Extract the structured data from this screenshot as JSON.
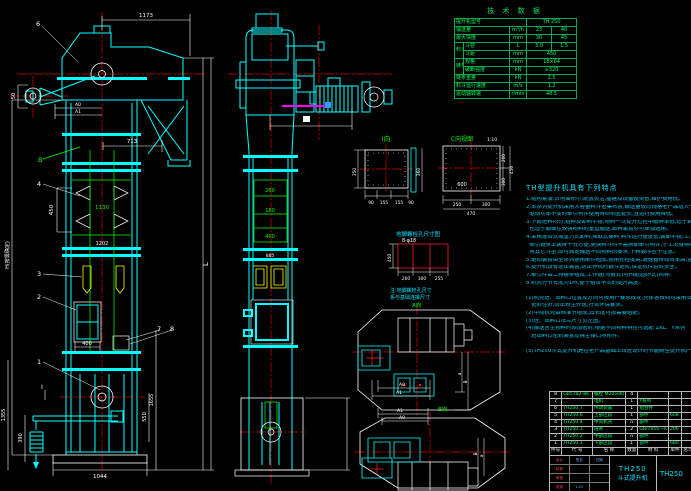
{
  "tech": {
    "title": "技 术 数 据",
    "rows": [
      {
        "label": "提升机型号",
        "v": "TH 250"
      },
      {
        "label": "输送量",
        "unit": "m³/h",
        "v1": "23",
        "v2": "40"
      },
      {
        "label": "最大块度",
        "unit": "mm",
        "v1": "30",
        "v2": "45"
      },
      {
        "group": "料斗",
        "label": "斗容",
        "unit": "L",
        "v1": "3.0",
        "v2": "1.5"
      },
      {
        "label": "斗距",
        "unit": "mm",
        "v": "450"
      },
      {
        "group": "链条",
        "label": "规格",
        "unit": "mm",
        "v": "18×64"
      },
      {
        "label": "破断强度",
        "unit": "kN",
        "v": "≥320"
      },
      {
        "label": "链条重量",
        "unit": "kN",
        "v": "2.5"
      },
      {
        "label": "料斗运行速度",
        "unit": "m/s",
        "v": "1.2"
      },
      {
        "label": "驱动轴转速",
        "unit": "r/min",
        "v": "48.5"
      }
    ]
  },
  "notes": {
    "title": "TH型提升机具有下列特点",
    "lines": [
      "1.结构紧凑,占地面积小,配置灵活,基建及设备投资省,维护费用低。",
      "2.本系列提升机采用大容量料斗密集布置,输送量较同规格老产品增大一倍,提升高度及",
      "  驱动功率不变时牵引构件使用寿命明显延长,且运行费用降低。",
      "3.下部进料均匀,给料及卸料平稳,物料一次提升过程中破碎率低,适于颗粒状及小块状,",
      "  也适于磨琢性较强物料的垂直输送,卸料装置亦可单独选用。",
      "4.采用混合式或重力式卸料,掏取式装料,料斗运行速度低,装卸平稳,工况适应性强,料斗在",
      "  牵引链条上装拆十分方便,更换料斗时不需拆卸牵引构件,于工况有特殊需要时可换",
      "  用其它斗型,即可满足输送不同物料的要求,下料顺序应予注意。",
      "5.驱动装置由全系列通用部件组成,通用化程度高,减速器传动效率高,运转可靠,噪声低。",
      "6.提升机设有逆止装置,防止停机时链斗逆转,保证机件运转安全。",
      "7.牵引件由二排链条组成,工作链(弯板式)与H链(圆环式)两种。",
      "8.机壳分节长度为1m,便于组合不同的提升高度。",
      "",
      "(1)机壳进、出料口位置及方向可按用户要求改变,壳体各段间均采用法兰密封连接,整机",
      "   密封性好,防止粉尘外逸,符合环保要求。",
      "(2)中间机壳由标准节组成,其长度可按需要组配。",
      "(3)进、出料口法兰尺寸见左图。",
      "(4)输送含尘物料时须加密封,根据不同物料特性可选配 ZKL、Y系列",
      "   进出料口密封装置及除尘接口等附件。",
      "",
      "(5)TH250斗式提升机是在老产品基础上改进设计的节能新型提升机产品。"
    ]
  },
  "bom": {
    "headers": [
      "件号",
      "代  号",
      "名  称",
      "数量",
      "材  料",
      "单件",
      "总计",
      "备注"
    ],
    "rows": [
      {
        "no": "8",
        "code": "GB5782-86",
        "name": "螺栓 M20×80",
        "qty": "4",
        "mat": "",
        "w": "",
        "note": ""
      },
      {
        "no": "7",
        "code": "",
        "name": "电机",
        "qty": "1",
        "mat": "Y系列",
        "w": "",
        "note": ""
      },
      {
        "no": "6",
        "code": "TH250.7",
        "name": "传动装置",
        "qty": "1",
        "mat": "组合件",
        "w": "",
        "note": ""
      },
      {
        "no": "5",
        "code": "TH250.6",
        "name": "上部区段",
        "qty": "1",
        "mat": "部件",
        "w": "608",
        "note": ""
      },
      {
        "no": "4",
        "code": "TH250.4",
        "name": "中间机壳",
        "qty": "n",
        "mat": "部件",
        "w": "",
        "note": ""
      },
      {
        "no": "3",
        "code": "TH250.3",
        "name": "链条",
        "qty": "2",
        "mat": "GB/T956—A",
        "w": "206",
        "note": ""
      },
      {
        "no": "2",
        "code": "TH250.2",
        "name": "中部区段",
        "qty": "n",
        "mat": "部件",
        "w": "",
        "note": ""
      },
      {
        "no": "1",
        "code": "TH250.1",
        "name": "下部区段",
        "qty": "1",
        "mat": "部件",
        "w": "680",
        "note": ""
      }
    ]
  },
  "title_block": {
    "model": "TH250",
    "product": "斗式提升机",
    "drawing_no": "TH250",
    "sig1": "设计",
    "sig2": "校核",
    "sig3": "审核",
    "sig4": "批准",
    "col1": "签名",
    "col2": "日期",
    "scale": "1:20"
  },
  "dims": {
    "left": {
      "d1173": "1173",
      "d713": "713",
      "d450": "450",
      "d1130": "1130",
      "d1202": "1202",
      "d400": "400",
      "d1044": "1044",
      "d1355": "1355",
      "d390": "390",
      "d550": "550",
      "d1655": "1655",
      "d50": "50",
      "a0": "A0",
      "a1": "A1",
      "h": "H(按需确定)",
      "l": "L",
      "secB": "B",
      "secI": "I",
      "b6": "6",
      "b4": "4",
      "b3": "3",
      "b2": "2",
      "b1": "1",
      "b7": "7",
      "b8": "8"
    },
    "mid": {
      "d260": "260",
      "d180": "180",
      "d400": "400",
      "d885": "885"
    },
    "vi": {
      "title": "I向",
      "d350": "350",
      "d360": "360",
      "b1": "90",
      "b2": "155",
      "b3": "155",
      "b4": "90"
    },
    "vc": {
      "title": "C向视图",
      "scale": "1:10",
      "d600": "600",
      "b1": "250",
      "b2": "300",
      "b3": "470",
      "r1": "200",
      "r2": "300",
      "r3": "450"
    },
    "anchor": {
      "title": "地脚螺栓孔尺寸图",
      "holes": "8-φ18",
      "d450": "450",
      "b1": "200",
      "b2": "300",
      "b3": "255",
      "note1": "注:地脚螺栓孔尺寸",
      "note2": "系与基础连接尺寸",
      "sec": "A向"
    },
    "hplan": {
      "a0": "A0",
      "a1": "A1",
      "ra": "a",
      "rb": "B"
    },
    "bplan": {
      "a0": "A0",
      "a1": "A1",
      "ra": "a",
      "rb": "B",
      "sec": "B向"
    }
  }
}
